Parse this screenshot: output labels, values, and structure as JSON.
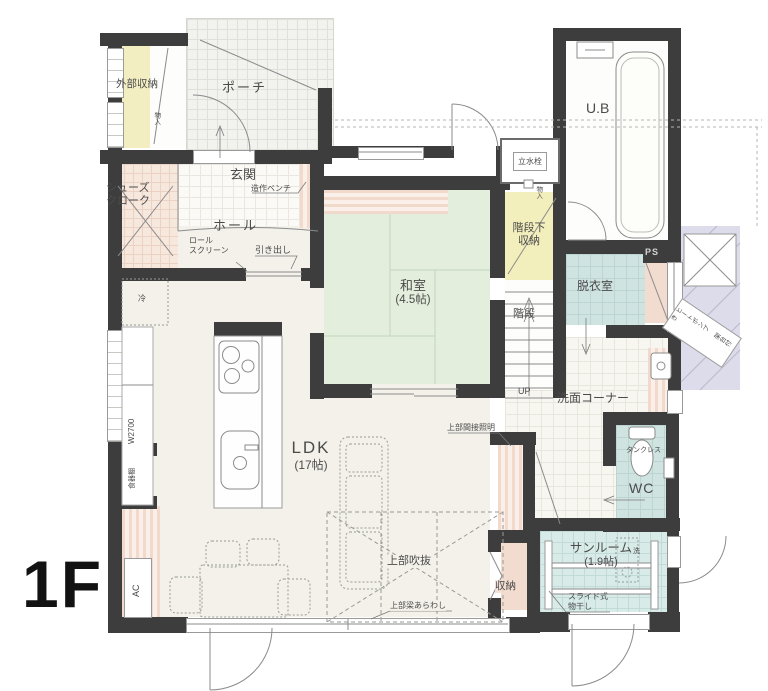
{
  "floor_plan": {
    "floor_label": "1F",
    "rooms": {
      "exterior_storage": "外部収納",
      "porch": "ポーチ",
      "shoes_cloak_line1": "シューズ",
      "shoes_cloak_line2": "クローク",
      "entrance": "玄関",
      "hall": "ホール",
      "washitsu_name": "和室",
      "washitsu_size": "(4.5帖)",
      "under_stairs_line1": "階段下",
      "under_stairs_line2": "収納",
      "stairs": "階段",
      "unit_bath": "U.B",
      "dressing_room": "脱衣室",
      "wash_corner": "洗面コーナー",
      "wc": "WC",
      "ldk_name": "LDK",
      "ldk_size": "(17帖)",
      "sunroom_name": "サンルーム",
      "sunroom_size": "(1.9帖)",
      "storage": "収納"
    },
    "annotations": {
      "bench": "造作ベンチ",
      "roll_screen_line1": "ロール",
      "roll_screen_line2": "スクリーン",
      "drawer": "引き出し",
      "up": "UP",
      "faucet": "立水栓",
      "ps": "PS",
      "tankless": "タンクレス",
      "heat_pump_line1": "ヒートポンプ",
      "heat_pump_line2": "架台付き",
      "void_above": "上部吹抜",
      "exposed_beam": "上部梁あらわし",
      "indirect_light": "上部間接照明",
      "slide_rack_line1": "スライド式",
      "slide_rack_line2": "物干し",
      "washer": "洗",
      "fridge": "冷",
      "counter_width": "W2700",
      "cupboard": "食器棚",
      "ac": "AC",
      "mono_ire": "物入"
    },
    "colors": {
      "wall": "#3d3d3d",
      "tatami_green": "#e3eedd",
      "storage_yellow": "#f3efbc",
      "wet_area_blue": "#cfe3e1",
      "sunroom_cyan": "#d8ebe8",
      "closet_pink": "#f2dcd0",
      "exterior_lavender": "#dcdcea",
      "floor_cream": "#f3f1ea"
    }
  }
}
